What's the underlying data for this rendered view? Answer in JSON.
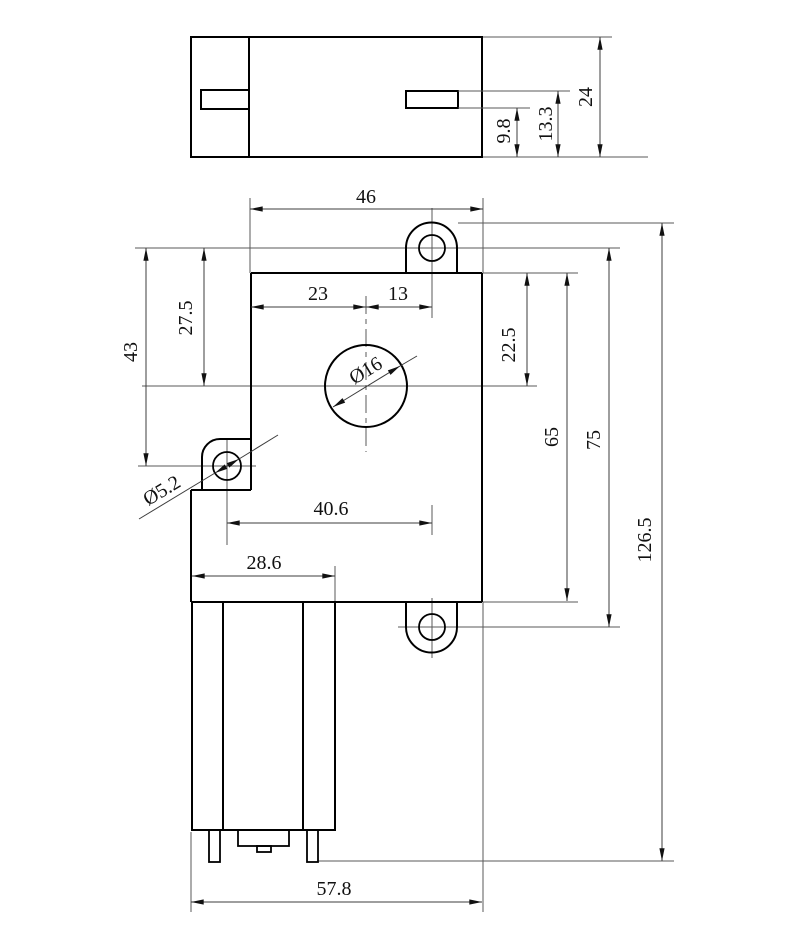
{
  "views": {
    "top": {
      "dims": {
        "overall_height": "24",
        "slot_top_to_base": "13.3",
        "slot_bottom_to_base": "9.8"
      }
    },
    "front": {
      "dims": {
        "gearbox_width": "46",
        "left_edge_to_shaft": "23",
        "shaft_to_lug_hole": "13",
        "lug_hole_to_shaft_vertical": "27.5",
        "lug_hole_to_side_hole_vertical": "43",
        "top_edge_to_shaft": "22.5",
        "gearbox_height": "65",
        "lug_hole_centers_vertical": "75",
        "overall_height": "126.5",
        "side_hole_to_lug_hole_horizontal": "40.6",
        "motor_width": "28.6",
        "overall_width": "57.8",
        "side_hole_diameter": "Ø5.2",
        "shaft_boss_diameter": "Ø16"
      }
    }
  }
}
